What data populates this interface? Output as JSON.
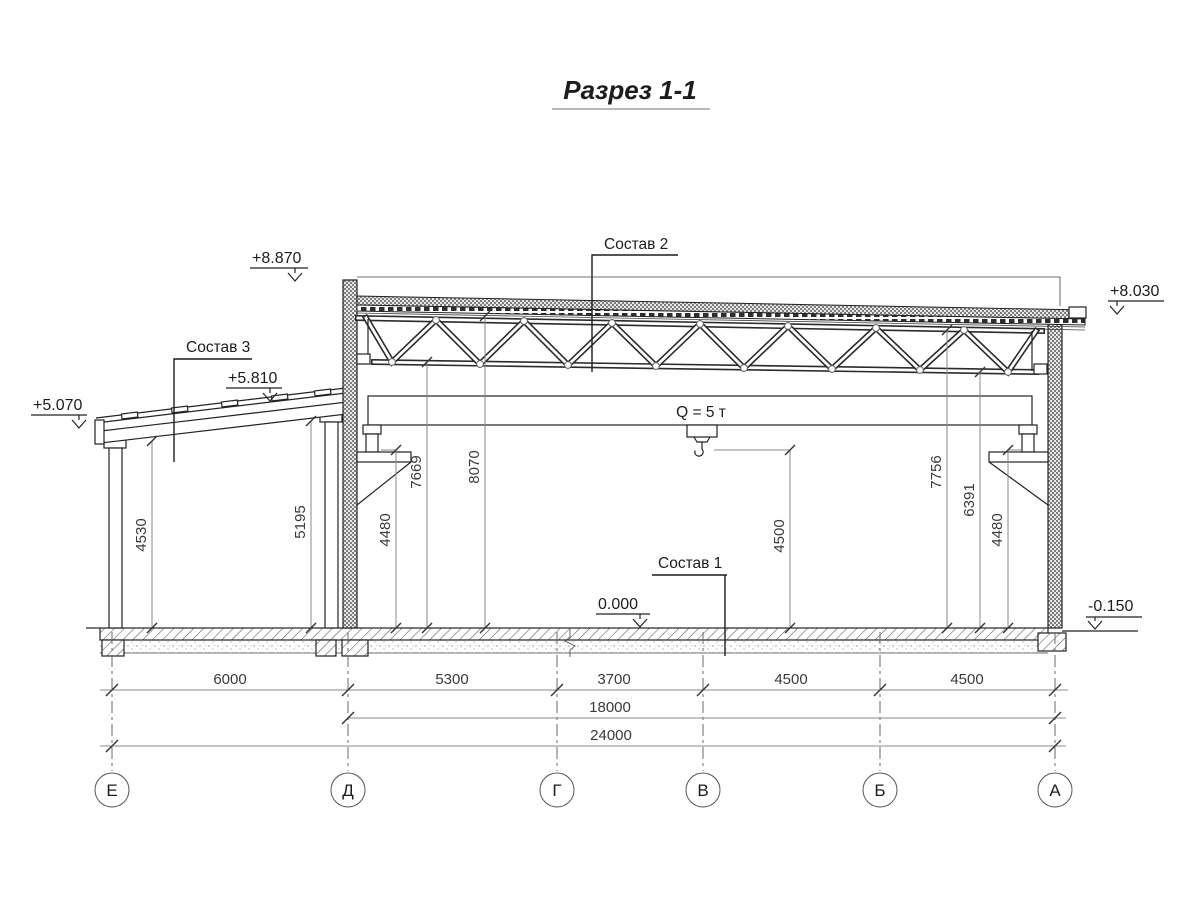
{
  "title": "Разрез 1-1",
  "labels": {
    "sostav1": "Состав 1",
    "sostav2": "Состав 2",
    "sostav3": "Состав 3",
    "crane_capacity": "Q = 5 т"
  },
  "elevations": {
    "parapet": "+8.870",
    "roof_right": "+8.030",
    "annex_high": "+5.810",
    "annex_low": "+5.070",
    "floor": "0.000",
    "ground": "-0.150"
  },
  "vertical_dims": {
    "annex_left": "4530",
    "annex_right": "5195",
    "rail_left": "4480",
    "truss_bottom_left": "7669",
    "roof_under_left": "8070",
    "hook_height": "4500",
    "roof_under_right": "7756",
    "truss_bottom_right": "6391",
    "rail_right": "4480"
  },
  "horizontal_dims": {
    "spans": [
      "6000",
      "5300",
      "3700",
      "4500",
      "4500"
    ],
    "crane_span": "18000",
    "total": "24000"
  },
  "axes": [
    "Е",
    "Д",
    "Г",
    "В",
    "Б",
    "А"
  ]
}
